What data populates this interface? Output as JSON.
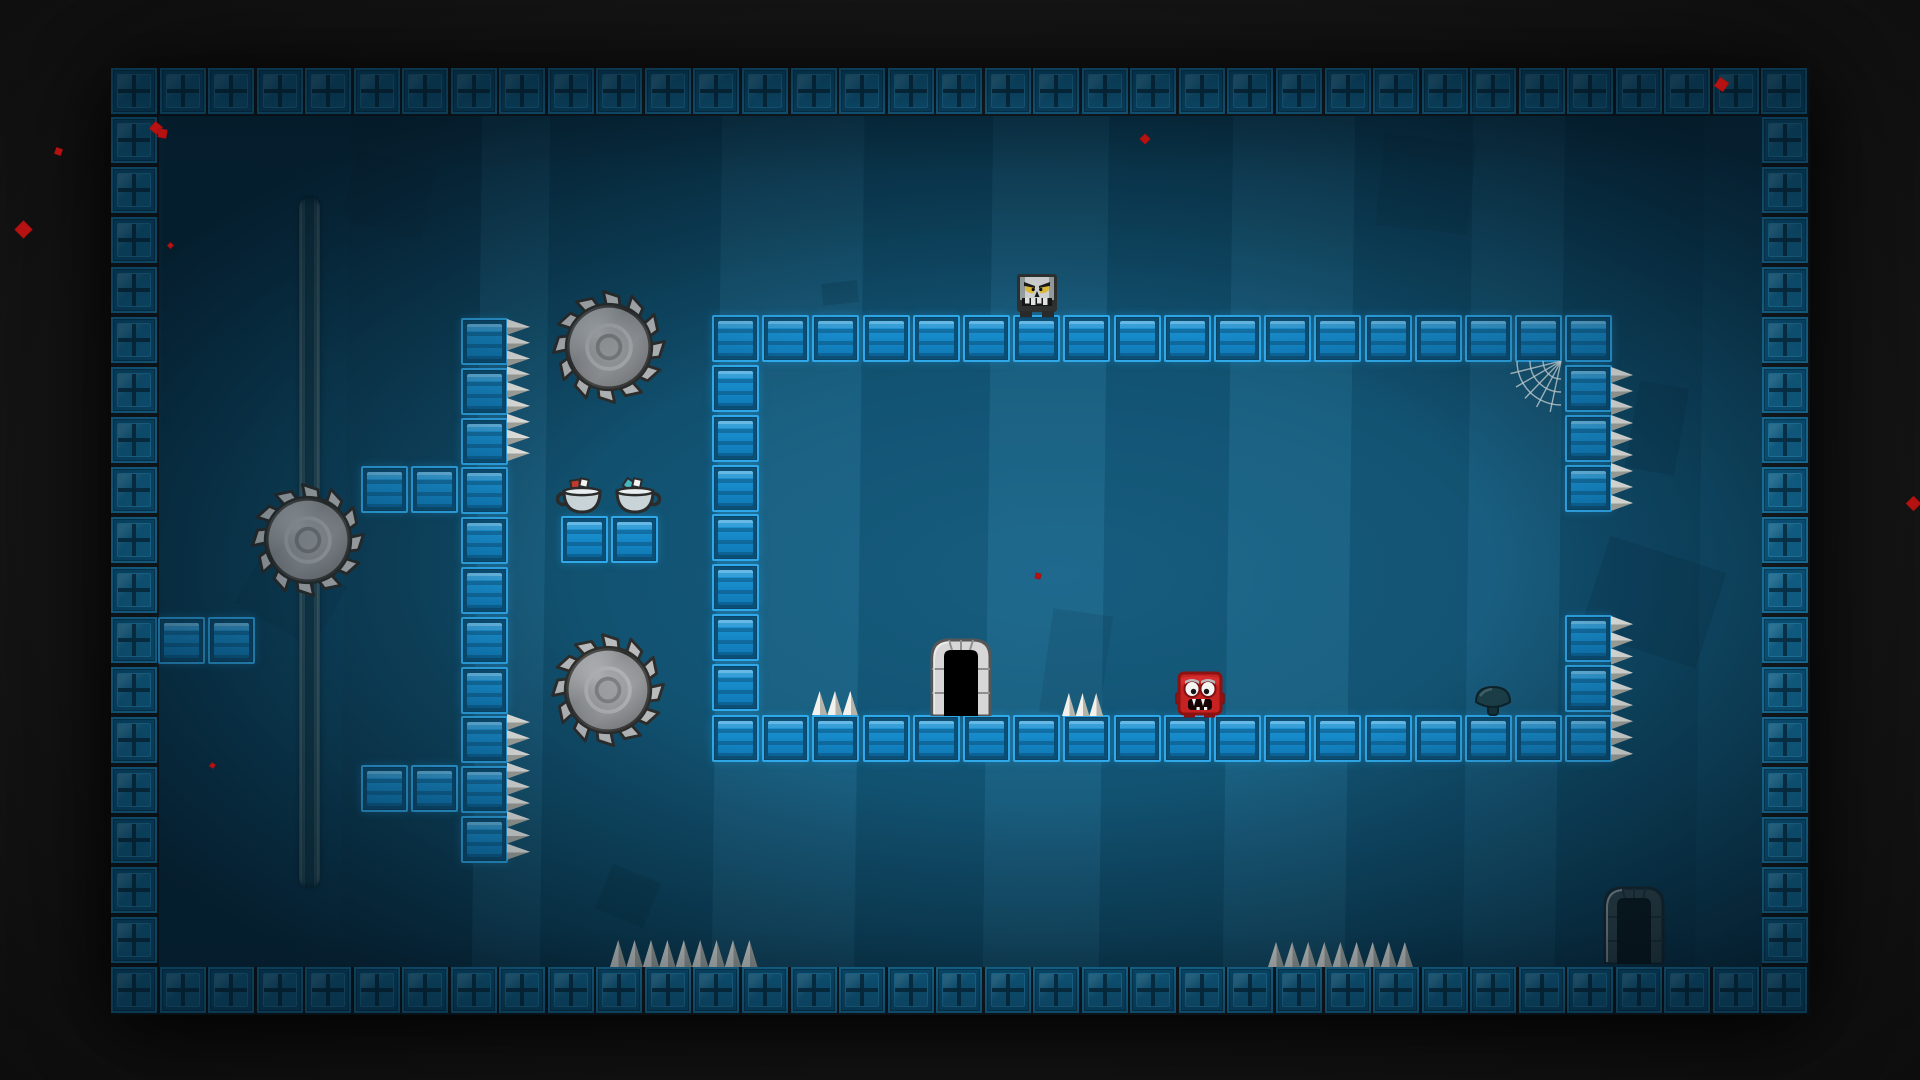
{
  "meta": {
    "scene": "platformer-game-level",
    "viewport": {
      "width": 1920,
      "height": 1080
    }
  },
  "palette": {
    "outer_background": "#1a1a1a",
    "interior_teal": "#155a7c",
    "border_tile_blue": "#1579aa",
    "platform_tile_blue": "#1d97d8",
    "spike_white": "#f2f1ec",
    "saw_gray": "#8b8d90",
    "blood_red": "#b61212",
    "skull_yellow_eyes": "#e8c23c",
    "player_red": "#c62222"
  },
  "level": {
    "frame": {
      "x": 111,
      "y": 68,
      "w": 1699,
      "h": 947
    },
    "interior": {
      "x": 159,
      "y": 116,
      "w": 1603,
      "h": 851
    },
    "border_tile_size": 46,
    "platform_tile_size": 47,
    "border_runs": [
      {
        "id": "border-top",
        "x": 111,
        "y": 68,
        "dx": 48.54,
        "dy": 0,
        "count": 35
      },
      {
        "id": "border-bottom",
        "x": 111,
        "y": 967,
        "dx": 48.54,
        "dy": 0,
        "count": 35
      },
      {
        "id": "border-left",
        "x": 111,
        "y": 116.5,
        "dx": 0,
        "dy": 50,
        "count": 17
      },
      {
        "id": "border-right",
        "x": 1762,
        "y": 116.5,
        "dx": 0,
        "dy": 50,
        "count": 17
      }
    ],
    "platform_segments": [
      {
        "id": "room-top-row",
        "x": 712,
        "y": 315,
        "cols": 18,
        "rows": 1
      },
      {
        "id": "room-bottom-row",
        "x": 712,
        "y": 715,
        "cols": 18,
        "rows": 1
      },
      {
        "id": "room-left-column",
        "x": 712,
        "y": 365,
        "cols": 1,
        "rows": 7
      },
      {
        "id": "room-right-column-upper",
        "x": 1565,
        "y": 365,
        "cols": 1,
        "rows": 3
      },
      {
        "id": "room-right-column-lower",
        "x": 1565,
        "y": 615,
        "cols": 1,
        "rows": 2
      },
      {
        "id": "pillar-column",
        "x": 461,
        "y": 318,
        "cols": 1,
        "rows": 11
      },
      {
        "id": "pillar-arm-upper",
        "x": 361,
        "y": 466,
        "cols": 2,
        "rows": 1
      },
      {
        "id": "pillar-arm-lower",
        "x": 361,
        "y": 765,
        "cols": 2,
        "rows": 1
      },
      {
        "id": "left-wall-ledge",
        "x": 158,
        "y": 617,
        "cols": 2,
        "rows": 1
      },
      {
        "id": "teacup-platform",
        "x": 561,
        "y": 516,
        "cols": 2,
        "rows": 1
      }
    ],
    "pitch": {
      "x": 50.2,
      "y": 49.8
    },
    "spikes_right": [
      {
        "id": "pillar-spikes-upper",
        "x": 507,
        "y": 319,
        "count": 9,
        "w": 23,
        "h": 15.8
      },
      {
        "id": "pillar-spikes-lower",
        "x": 507,
        "y": 714,
        "count": 9,
        "w": 23,
        "h": 16.2
      },
      {
        "id": "room-right-spikes-upper",
        "x": 1611,
        "y": 367,
        "count": 9,
        "w": 22,
        "h": 16
      },
      {
        "id": "room-right-spikes-lower",
        "x": 1611,
        "y": 616,
        "count": 9,
        "w": 22,
        "h": 16.2
      }
    ],
    "spikes_up": [
      {
        "id": "floor-spikes-west",
        "x": 610,
        "y": 940,
        "count": 9,
        "w": 16.4,
        "h": 27
      },
      {
        "id": "floor-spikes-east",
        "x": 1268,
        "y": 942,
        "count": 9,
        "w": 16.1,
        "h": 25
      },
      {
        "id": "room-floor-spikes-left",
        "x": 812,
        "y": 691,
        "count": 3,
        "w": 15.3,
        "h": 24
      },
      {
        "id": "room-floor-spikes-right",
        "x": 1062,
        "y": 693,
        "count": 3,
        "w": 13.7,
        "h": 23
      }
    ],
    "saw_track": {
      "x": 299,
      "y": 197,
      "w": 21,
      "h": 691
    },
    "saws": [
      {
        "id": "saw-on-rail",
        "cx": 308,
        "cy": 540,
        "r": 57
      },
      {
        "id": "saw-upper",
        "cx": 609,
        "cy": 347,
        "r": 57
      },
      {
        "id": "saw-lower",
        "cx": 608,
        "cy": 690,
        "r": 57
      }
    ],
    "entities": {
      "skull_enemy": {
        "x": 1016,
        "y": 273,
        "w": 42,
        "h": 44
      },
      "player_red": {
        "x": 1175,
        "y": 671,
        "w": 50,
        "h": 47
      },
      "exit_door": {
        "x": 929,
        "y": 636,
        "w": 64,
        "h": 80
      },
      "ghost_door": {
        "x": 1602,
        "y": 884,
        "w": 64,
        "h": 80
      },
      "teacups": [
        {
          "x": 556,
          "y": 477,
          "w": 52,
          "h": 42,
          "handle": "left",
          "cube_color": "#c23b2e"
        },
        {
          "x": 609,
          "y": 477,
          "w": 52,
          "h": 42,
          "handle": "right",
          "cube_color": "#49b6c4"
        }
      ],
      "mushroom": {
        "x": 1474,
        "y": 684,
        "w": 38,
        "h": 33
      },
      "spider_web": {
        "x": 1505,
        "y": 361,
        "w": 57,
        "h": 53
      }
    },
    "background_shapes": [
      {
        "x": 348,
        "y": 158,
        "w": 82,
        "h": 72,
        "rot": 14,
        "op": 0.14
      },
      {
        "x": 822,
        "y": 282,
        "w": 36,
        "h": 22,
        "rot": -6,
        "op": 0.18
      },
      {
        "x": 1632,
        "y": 384,
        "w": 50,
        "h": 88,
        "rot": 10,
        "op": 0.16
      },
      {
        "x": 1592,
        "y": 552,
        "w": 122,
        "h": 100,
        "rot": 18,
        "op": 0.16
      },
      {
        "x": 602,
        "y": 872,
        "w": 52,
        "h": 48,
        "rot": 22,
        "op": 0.18
      },
      {
        "x": 1380,
        "y": 138,
        "w": 92,
        "h": 92,
        "rot": 6,
        "op": 0.12
      },
      {
        "x": 1046,
        "y": 612,
        "w": 60,
        "h": 104,
        "rot": 8,
        "op": 0.12
      },
      {
        "x": 246,
        "y": 560,
        "w": 90,
        "h": 70,
        "rot": 30,
        "op": 0.1
      }
    ],
    "background_streaks": {
      "dark": [
        {
          "x": 159,
          "w": 186,
          "op": 0.12
        },
        {
          "x": 345,
          "w": 132,
          "op": 0.17
        },
        {
          "x": 545,
          "w": 172,
          "op": 0.1
        },
        {
          "x": 860,
          "w": 128,
          "op": 0.1
        },
        {
          "x": 1104,
          "w": 124,
          "op": 0.1
        },
        {
          "x": 1350,
          "w": 118,
          "op": 0.09
        },
        {
          "x": 1560,
          "w": 140,
          "op": 0.12
        }
      ],
      "light": [
        {
          "x": 477,
          "w": 68,
          "op": 0.05
        },
        {
          "x": 717,
          "w": 142,
          "op": 0.05
        },
        {
          "x": 988,
          "w": 116,
          "op": 0.05
        },
        {
          "x": 1228,
          "w": 122,
          "op": 0.05
        },
        {
          "x": 1468,
          "w": 92,
          "op": 0.04
        }
      ]
    },
    "blood_particles": [
      {
        "x": 17,
        "y": 223,
        "s": 13,
        "rot": 45
      },
      {
        "x": 55,
        "y": 148,
        "s": 7,
        "rot": 20
      },
      {
        "x": 151,
        "y": 123,
        "s": 10,
        "rot": 40
      },
      {
        "x": 158,
        "y": 129,
        "s": 9,
        "rot": 10
      },
      {
        "x": 168,
        "y": 243,
        "s": 5,
        "rot": 45
      },
      {
        "x": 210,
        "y": 763,
        "s": 5,
        "rot": 30
      },
      {
        "x": 1141,
        "y": 135,
        "s": 8,
        "rot": 45
      },
      {
        "x": 1035,
        "y": 573,
        "s": 6,
        "rot": 15
      },
      {
        "x": 1716,
        "y": 79,
        "s": 11,
        "rot": 35
      },
      {
        "x": 1908,
        "y": 498,
        "s": 11,
        "rot": 45
      }
    ]
  }
}
